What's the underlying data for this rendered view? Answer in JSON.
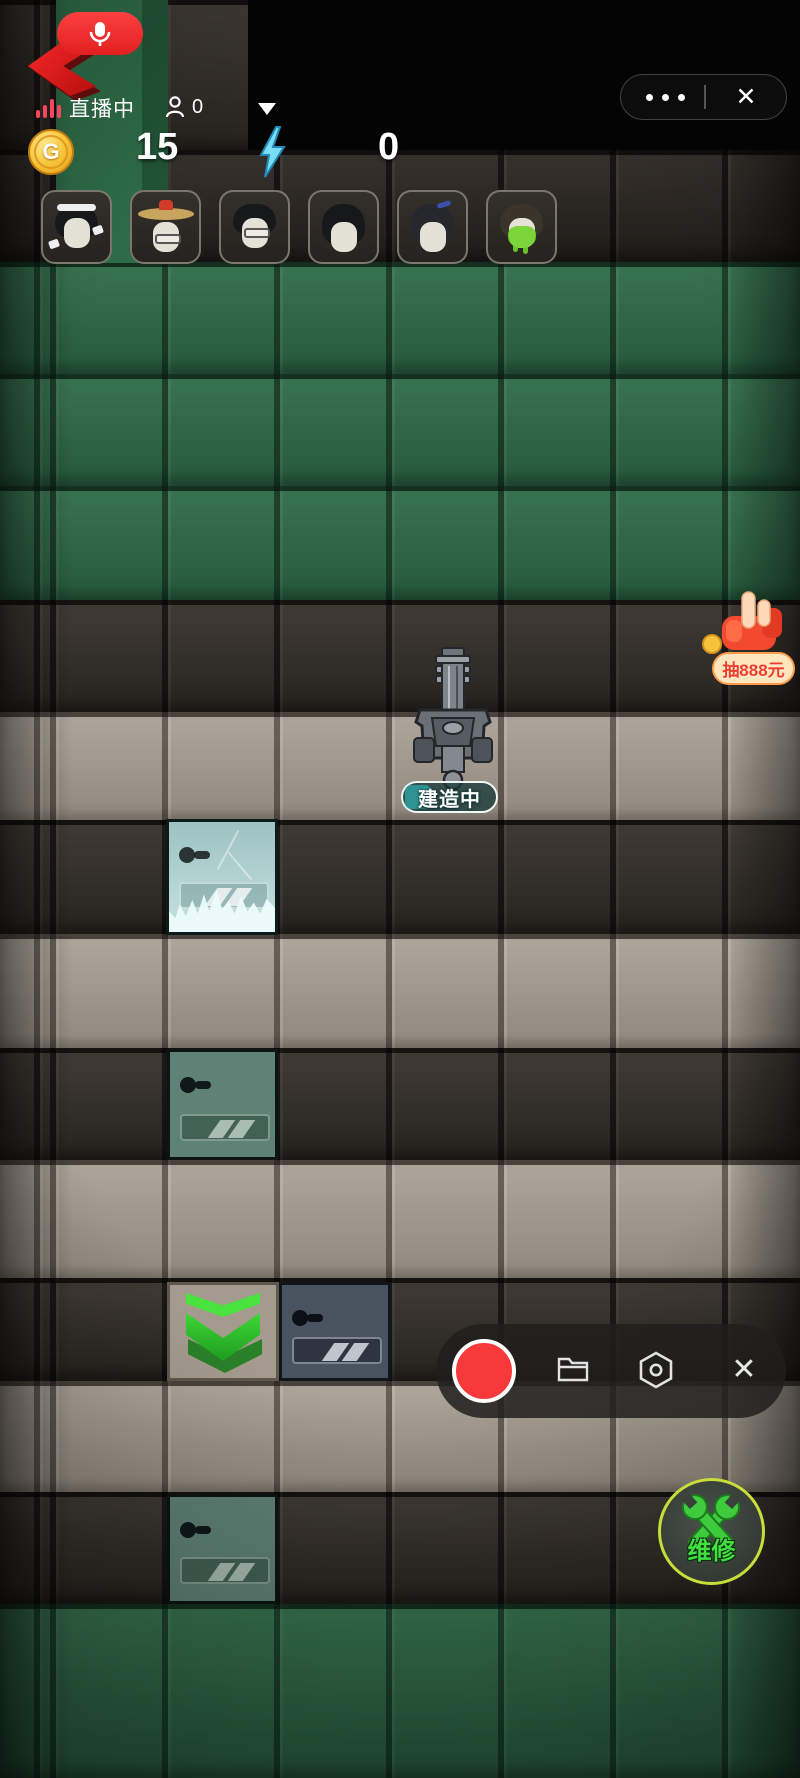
{
  "live_header": {
    "mic_button": {
      "icon": "microphone-icon"
    },
    "back_arrow": {
      "icon": "back-arrow-icon"
    },
    "live_status": {
      "icon": "signal-bars-icon",
      "label": "直播中"
    },
    "viewers": {
      "icon": "viewer-icon",
      "count": "0"
    },
    "dropdown": {
      "icon": "dropdown-icon"
    },
    "capsule": {
      "more_icon": "more-icon",
      "close_icon": "close-icon",
      "close_glyph": "✕"
    }
  },
  "resources": {
    "coin": {
      "icon": "coin-icon",
      "letter": "G",
      "value": "15"
    },
    "energy": {
      "icon": "lightning-icon",
      "value": "0"
    }
  },
  "party": {
    "avatars": [
      {
        "name": "avatar-girl-headband"
      },
      {
        "name": "avatar-elder-straw-hat"
      },
      {
        "name": "avatar-glasses-kid"
      },
      {
        "name": "avatar-black-bob"
      },
      {
        "name": "avatar-blue-hairpin"
      },
      {
        "name": "avatar-slimed-face"
      }
    ]
  },
  "board": {
    "build_label": "建造中",
    "special_tiles": [
      "frozen-turret-slot",
      "teal-turret-slot",
      "slate-turret-slot",
      "upgrade-chevron-tile",
      "teal-turret-slot-2"
    ]
  },
  "promo_badge": {
    "label": "抽888元",
    "icon": "pointing-hand-icon"
  },
  "recorder": {
    "record_icon": "record-icon",
    "folder_icon": "folder-icon",
    "settings_icon": "settings-icon",
    "close_icon": "close-icon",
    "close_glyph": "✕"
  },
  "repair_button": {
    "label": "维修",
    "icon": "crossed-wrenches-icon"
  },
  "colors": {
    "accent_red": "#f0392f",
    "live_pink": "#f5465d",
    "coin_gold": "#f6c63c",
    "energy_blue": "#6fd8f5",
    "upgrade_green": "#3fdc3a",
    "repair_green": "#3fe03f",
    "badge_cream": "#ffe6bd",
    "badge_text": "#f03e2e",
    "grass_green": "#2e6c47",
    "tile_tan": "#a49b8e"
  }
}
